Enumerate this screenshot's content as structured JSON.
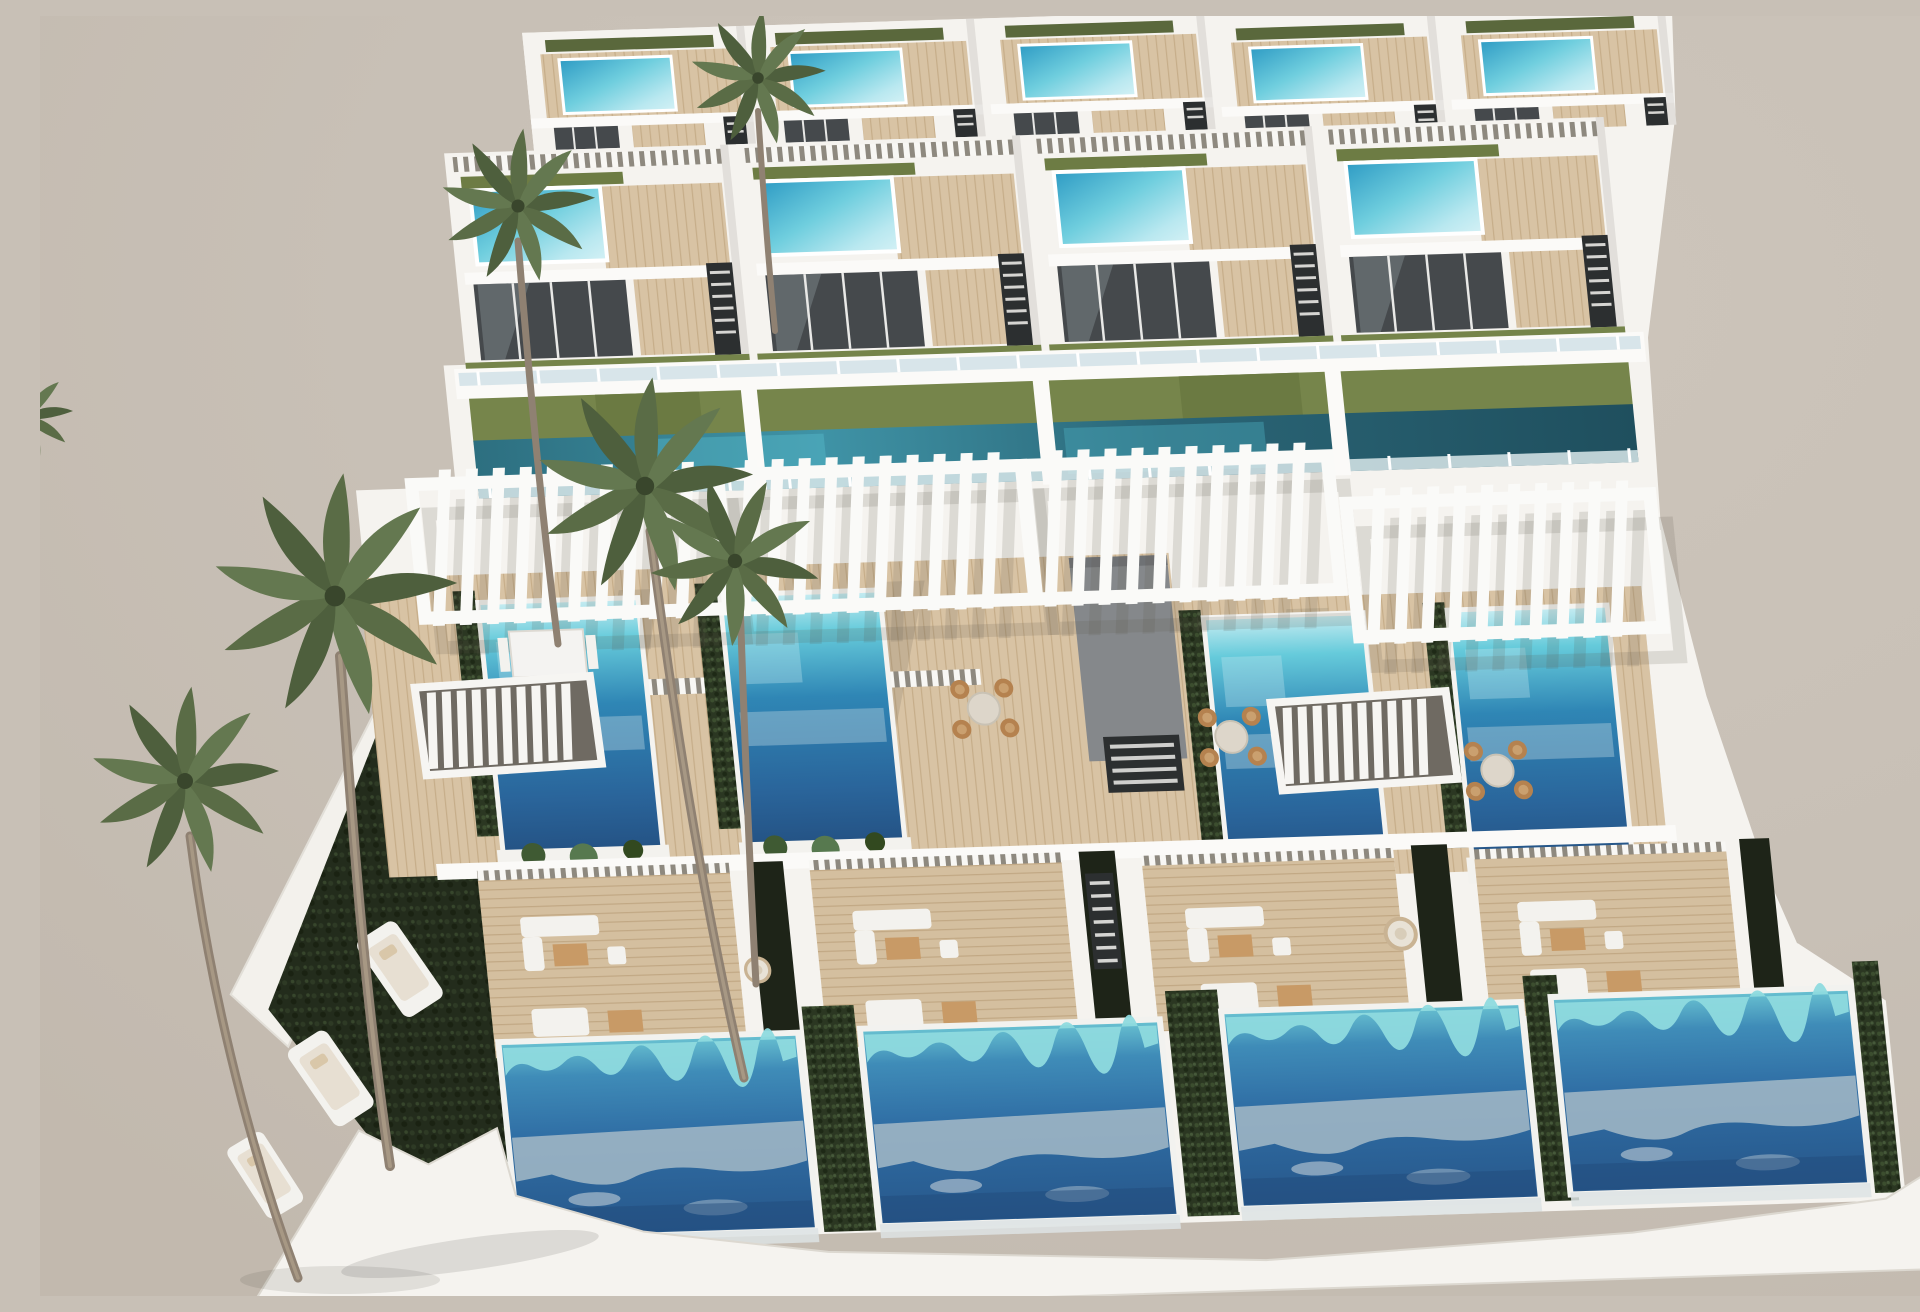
{
  "scene": {
    "type": "architectural-render",
    "description": "Aerial three-quarter 3D rendering of a modern terraced white villa complex: top row of penthouses with small turquoise rooftop pools, a second tier of villas with roof pools and glass facades, white slatted pergolas over private mid-level pools lined with hedges, wooden sun decks with outdoor furniture, four large deep-blue ground-floor pools, a dark green lawn with white sun loungers, tall palm trees, all under a plain warm grey sky.",
    "view": "high-angle aerial, slight perspective tilt",
    "sky": "plain warm grey, no clouds",
    "lighting": "bright daylight with soft shadows"
  },
  "palette": {
    "sky": "#c8c0b6",
    "sky_light": "#cdc5bb",
    "sky_deep": "#c2b9ae",
    "wall_white": "#f5f3ef",
    "parapet": "#fbfaf8",
    "wall_shade": "#e3e0da",
    "deck_wood": "#d8c3a4",
    "deck_wood_dark": "#c6ad89",
    "walkway_grey": "#85888b",
    "glass_dark": "#45494c",
    "glass_sky_reflect": "#cfe0e6",
    "rooftop_pool_blue": "#2e9bc4",
    "rooftop_pool_light": "#d4f1f5",
    "mid_pool_turquoise": "#66cbdb",
    "mid_pool_deep": "#234f80",
    "ground_pool_fringe": "#6ac3d2",
    "ground_pool_deep": "#27578a",
    "pool_foam": "#a5bac7",
    "lap_pool_teal": "#2d6f80",
    "lawn_olive": "#76854b",
    "lawn_dark": "#232c1c",
    "hedge_green": "#2b3722",
    "palm_green": "#5a6c46",
    "palm_green_dark": "#4e5f3d",
    "palm_trunk": "#8f8172",
    "stair_dark": "#2c2f30",
    "furniture_white": "#f3f2ee",
    "furniture_wood": "#c89a66",
    "rattan": "#b5824f",
    "shadow_warm": "#5c564c"
  },
  "inventory": {
    "villas": 12,
    "rooftop_pools": 9,
    "mid_level_pools": 4,
    "ground_pools": 4,
    "lap_pool_segments": 4,
    "pergolas": 4,
    "palm_trees": 6,
    "sun_loungers": 3,
    "dining_sets": 3,
    "sofa_sets": 4,
    "hanging_chairs": 2,
    "staircases": 10
  }
}
